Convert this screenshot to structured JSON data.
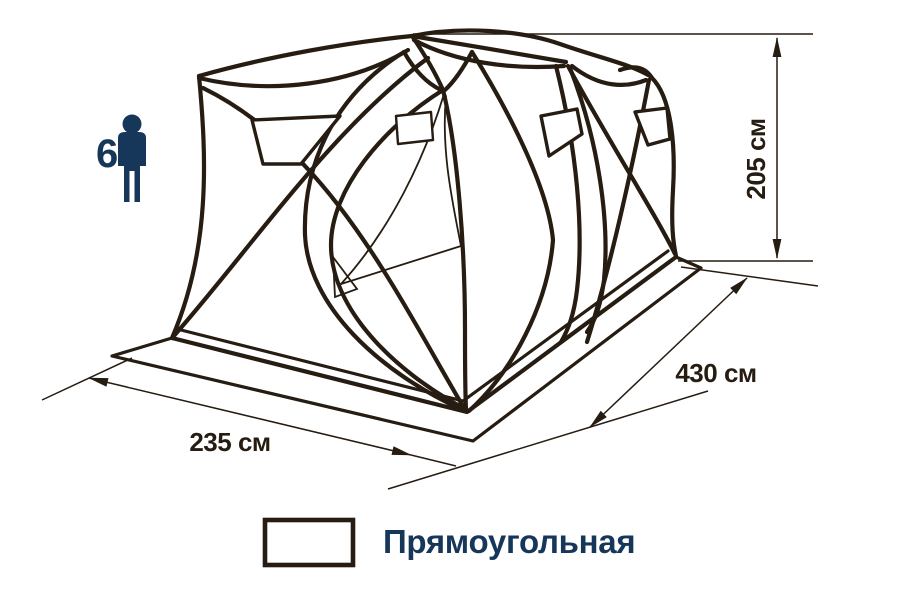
{
  "diagram_type": "tent-dimension-drawing",
  "dimensions": {
    "height": "205 см",
    "length": "430 см",
    "width": "235 см"
  },
  "capacity": {
    "value": "6",
    "icon": "person-icon"
  },
  "legend": {
    "shape_label": "Прямоугольная",
    "icon": "rectangle-icon"
  },
  "colors": {
    "line": "#261c11",
    "accent_navy": "#16365a",
    "background": "#ffffff"
  }
}
